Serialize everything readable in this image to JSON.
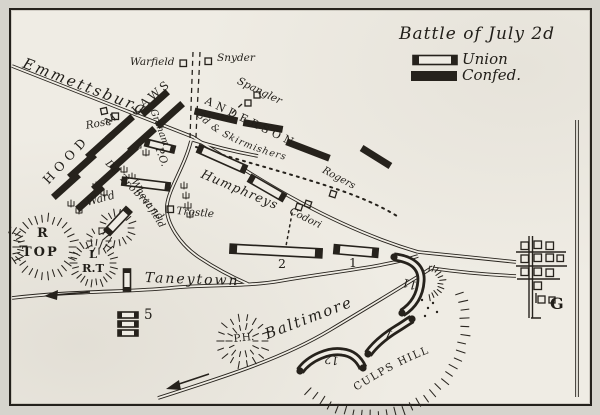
{
  "legend": {
    "title": "Battle of July 2d",
    "union": "Union",
    "confed": "Confed."
  },
  "roads": {
    "emmettsburg": "Emmettsburg",
    "taneytown": "Taneytown",
    "baltimore": "Baltimore"
  },
  "confederate": {
    "hood": "HOOD",
    "mclaws_m": "M",
    "laws": "LAWS",
    "anderson": "ANDERSON",
    "skirmishers": "3d & Skirmishers"
  },
  "union": {
    "graham": "Graham",
    "humphreys": "Humphreys",
    "de_trobriand": "De Trobriand",
    "ward": "Ward",
    "corps_1": "1",
    "corps_2": "2",
    "corps_5": "5",
    "corps_11": "11",
    "corps_12": "12",
    "corps_1_culps": "1"
  },
  "farms": {
    "warfield": "Warfield",
    "snyder": "Snyder",
    "spangler": "Spangler",
    "rose": "Rose",
    "trostle": "Trostle",
    "rogers": "Rogers",
    "codori": "Codori"
  },
  "terrain": {
    "round_top_line1": "R",
    "round_top_line2": "TOP",
    "little_round_top_line1": "L",
    "little_round_top_line2": "R.T",
    "wheat_field": "Wheat field",
    "peach_orchard": "P.O.",
    "powers_hill": "P.H.",
    "culps_hill": "CULPS HILL",
    "gettysburg_g": "G"
  }
}
